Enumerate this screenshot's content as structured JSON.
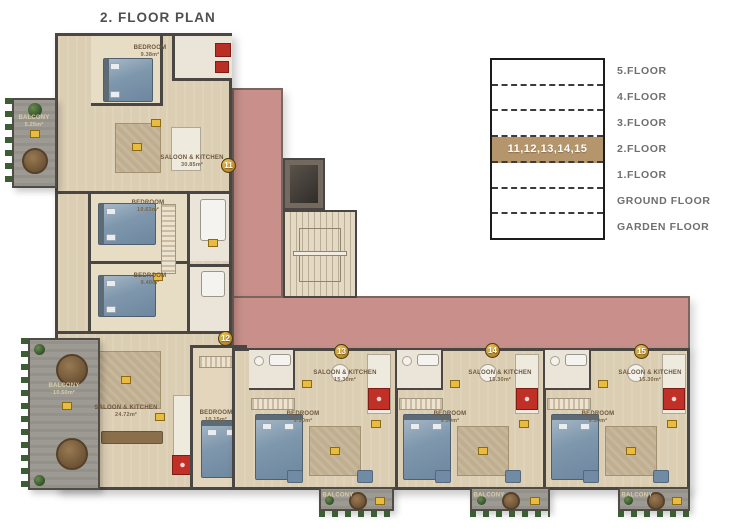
{
  "title": "2. FLOOR PLAN",
  "colors": {
    "highlight_band": "#b5956b",
    "terrace_roof": "#c9908b",
    "walls": "#4a4643",
    "floor": "#dbceb3",
    "unit_badge": "#c29031"
  },
  "legend": {
    "floors": [
      {
        "label": "5.FLOOR",
        "highlighted": false
      },
      {
        "label": "4.FLOOR",
        "highlighted": false
      },
      {
        "label": "3.FLOOR",
        "highlighted": false
      },
      {
        "label": "2.FLOOR",
        "highlighted": true,
        "units": "11,12,13,14,15"
      },
      {
        "label": "1.FLOOR",
        "highlighted": false
      },
      {
        "label": "GROUND FLOOR",
        "highlighted": false
      },
      {
        "label": "GARDEN FLOOR",
        "highlighted": false
      }
    ]
  },
  "units": {
    "u11": "11",
    "u12": "12",
    "u13": "13",
    "u14": "14",
    "u15": "15"
  },
  "rooms": {
    "u11_bedroom": {
      "name": "BEDROOM",
      "area": "9.38m²"
    },
    "u11_saloon": {
      "name": "SALOON & KITCHEN",
      "area": "30.85m²"
    },
    "u11_balcony": {
      "name": "BALCONY",
      "area": "5.25m²"
    },
    "u12_bedroom1": {
      "name": "BEDROOM",
      "area": "10.63m²"
    },
    "u12_bedroom2": {
      "name": "BEDROOM",
      "area": "9.40m²"
    },
    "u12_saloon": {
      "name": "SALOON & KITCHEN",
      "area": "24.72m²"
    },
    "u12_balcony": {
      "name": "BALCONY",
      "area": "10.50m²"
    },
    "u12_bedroom3": {
      "name": "BEDROOM",
      "area": "10.15m²"
    },
    "u13_saloon": {
      "name": "SALOON & KITCHEN",
      "area": "15.30m²"
    },
    "u13_bedroom": {
      "name": "BEDROOM",
      "area": "9.50m²"
    },
    "u13_balcony": {
      "name": "BALCONY",
      "area": "4.05m²"
    },
    "u14_saloon": {
      "name": "SALOON & KITCHEN",
      "area": "15.30m²"
    },
    "u14_bedroom": {
      "name": "BEDROOM",
      "area": "9.50m²"
    },
    "u14_balcony": {
      "name": "BALCONY",
      "area": "4.05m²"
    },
    "u15_saloon": {
      "name": "SALOON & KITCHEN",
      "area": "15.30m²"
    },
    "u15_bedroom": {
      "name": "BEDROOM",
      "area": "9.50m²"
    },
    "u15_balcony": {
      "name": "BALCONY",
      "area": "4.05m²"
    }
  }
}
